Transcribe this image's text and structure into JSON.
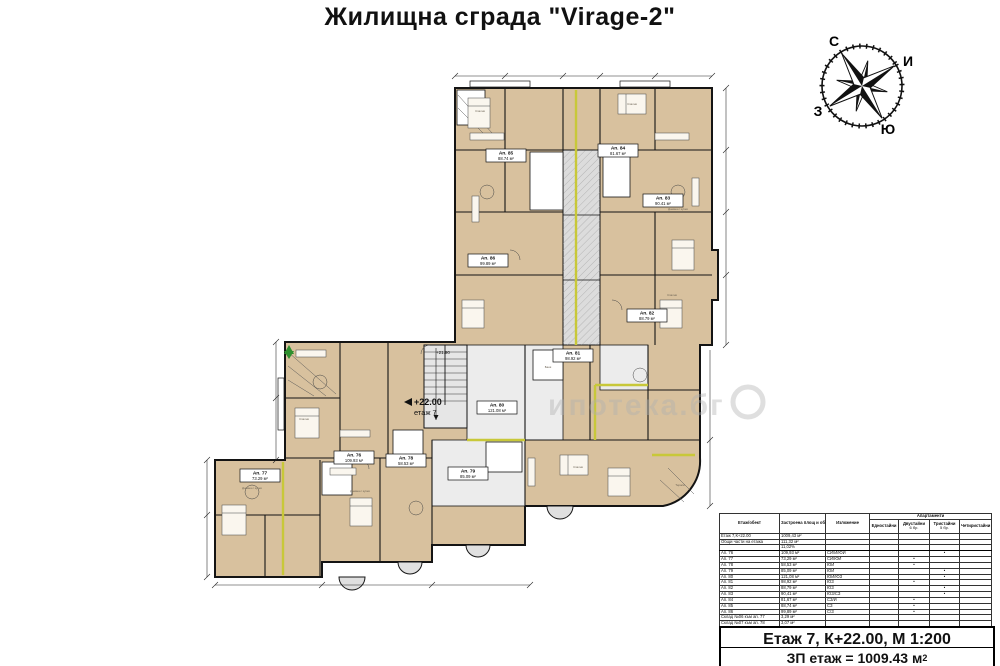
{
  "title": "Жилищна сграда \"Virage-2\"",
  "compass": {
    "north": "С",
    "east": "И",
    "south": "Ю",
    "west": "З"
  },
  "plan": {
    "level_elevation": "+22.00",
    "level_floor": "етаж 7",
    "stair_elevation": "+21.90",
    "watermark": "ипотека.бг",
    "apartments": [
      {
        "label": "Ап. 76",
        "area": "109.93 м²"
      },
      {
        "label": "Ап. 77",
        "area": "73.29 м²"
      },
      {
        "label": "Ап. 78",
        "area": "58.53 м²"
      },
      {
        "label": "Ап. 79",
        "area": "85.09 м²"
      },
      {
        "label": "Ап. 80",
        "area": "121.08 м²"
      },
      {
        "label": "Ап. 81",
        "area": "98.92 м²"
      },
      {
        "label": "Ап. 82",
        "area": "88.79 м²"
      },
      {
        "label": "Ап. 83",
        "area": "90.41 м²"
      },
      {
        "label": "Ап. 84",
        "area": "81.67 м²"
      },
      {
        "label": "Ап. 85",
        "area": "88.74 м²"
      },
      {
        "label": "Ап. 86",
        "area": "99.89 м²"
      }
    ],
    "room_labels": [
      "Дневна с кухня",
      "Спалня",
      "Спалня",
      "Дневна с кухня",
      "Спалня",
      "Баня",
      "Дневна с кухня",
      "Спалня",
      "Тераса",
      "Спалня"
    ]
  },
  "table": {
    "col_object": "Етаж/обект",
    "col_area": "Застроена площ и обекти, м²",
    "col_exposure": "Изложение",
    "group_apartments": "Апартаменти",
    "col_one": "Едностайни",
    "col_two": "Двустайни",
    "col_two_count": "6 бр.",
    "col_three": "Тристайни",
    "col_three_count": "5 бр.",
    "col_four": "Четиристайни",
    "summary": [
      {
        "name": "Етаж 7,К+22.00",
        "value": "1009,43 м²"
      },
      {
        "name": "Общи части на етажа",
        "value": "111,32 м²"
      },
      {
        "name": "",
        "value": "11,02%"
      }
    ],
    "rows": [
      {
        "name": "Ап. 76",
        "area": "109,93 м²",
        "exposure": "СИ/И/ЮИ",
        "d1": "",
        "d2": "",
        "d3": "•",
        "d4": ""
      },
      {
        "name": "Ап. 77",
        "area": "73,29 м²",
        "exposure": "СИ/ЮИ",
        "d1": "",
        "d2": "•",
        "d3": "",
        "d4": ""
      },
      {
        "name": "Ап. 78",
        "area": "58,53 м²",
        "exposure": "ЮИ",
        "d1": "",
        "d2": "•",
        "d3": "",
        "d4": ""
      },
      {
        "name": "Ап. 79",
        "area": "85,09 м²",
        "exposure": "ЮИ",
        "d1": "",
        "d2": "",
        "d3": "•",
        "d4": ""
      },
      {
        "name": "Ап. 80",
        "area": "121,08 м²",
        "exposure": "ЮИ/ЮЗ",
        "d1": "",
        "d2": "",
        "d3": "•",
        "d4": ""
      },
      {
        "name": "Ап. 81",
        "area": "98,92 м²",
        "exposure": "ЮЗ",
        "d1": "",
        "d2": "•",
        "d3": "",
        "d4": ""
      },
      {
        "name": "Ап. 82",
        "area": "88,79 м²",
        "exposure": "ЮЗ",
        "d1": "",
        "d2": "",
        "d3": "•",
        "d4": ""
      },
      {
        "name": "Ап. 83",
        "area": "90,41 м²",
        "exposure": "ЮЗ/СЗ",
        "d1": "",
        "d2": "",
        "d3": "•",
        "d4": ""
      },
      {
        "name": "Ап. 84",
        "area": "81,67 м²",
        "exposure": "СЗ/И",
        "d1": "",
        "d2": "•",
        "d3": "",
        "d4": ""
      },
      {
        "name": "Ап. 85",
        "area": "88,74 м²",
        "exposure": "СЗ",
        "d1": "",
        "d2": "•",
        "d3": "",
        "d4": ""
      },
      {
        "name": "Ап. 86",
        "area": "99,89 м²",
        "exposure": "С/З",
        "d1": "",
        "d2": "•",
        "d3": "",
        "d4": ""
      }
    ],
    "storage_rows": [
      {
        "name": "Склад №06 към ап. 77",
        "area": "3,29 м²"
      },
      {
        "name": "Склад №07 към ап. 78",
        "area": "3,07 м²"
      },
      {
        "name": "Склад №08 към ап. 79",
        "area": "5,07 м²"
      }
    ]
  },
  "footer": {
    "line1": "Етаж 7, К+22.00, М 1:200",
    "line2_prefix": "ЗП етаж = 1009.43 м",
    "line2_sup": "2"
  }
}
